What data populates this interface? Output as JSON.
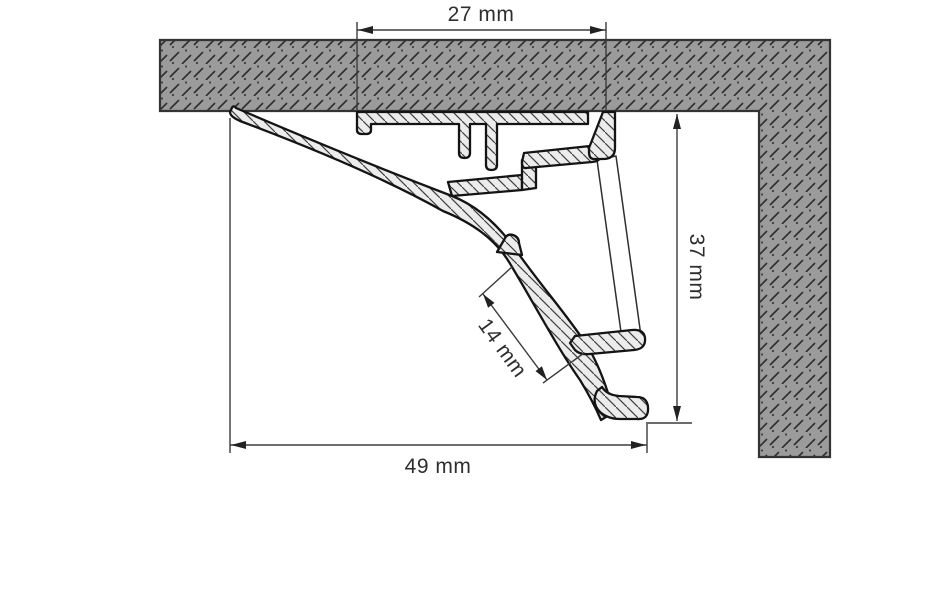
{
  "drawing": {
    "dimensions": {
      "top": "27 mm",
      "right": "37 mm",
      "inner": "14 mm",
      "bottom": "49 mm"
    },
    "colors": {
      "background": "#ffffff",
      "wall_fill": "#9b9b9b",
      "wall_hatch": "#2e2e2e",
      "aluminum_fill": "#ececec",
      "aluminum_hatch": "#3f3f3f",
      "outline": "#141414",
      "dimension_line": "#3b3b3b",
      "text": "#2e2e2e"
    }
  }
}
